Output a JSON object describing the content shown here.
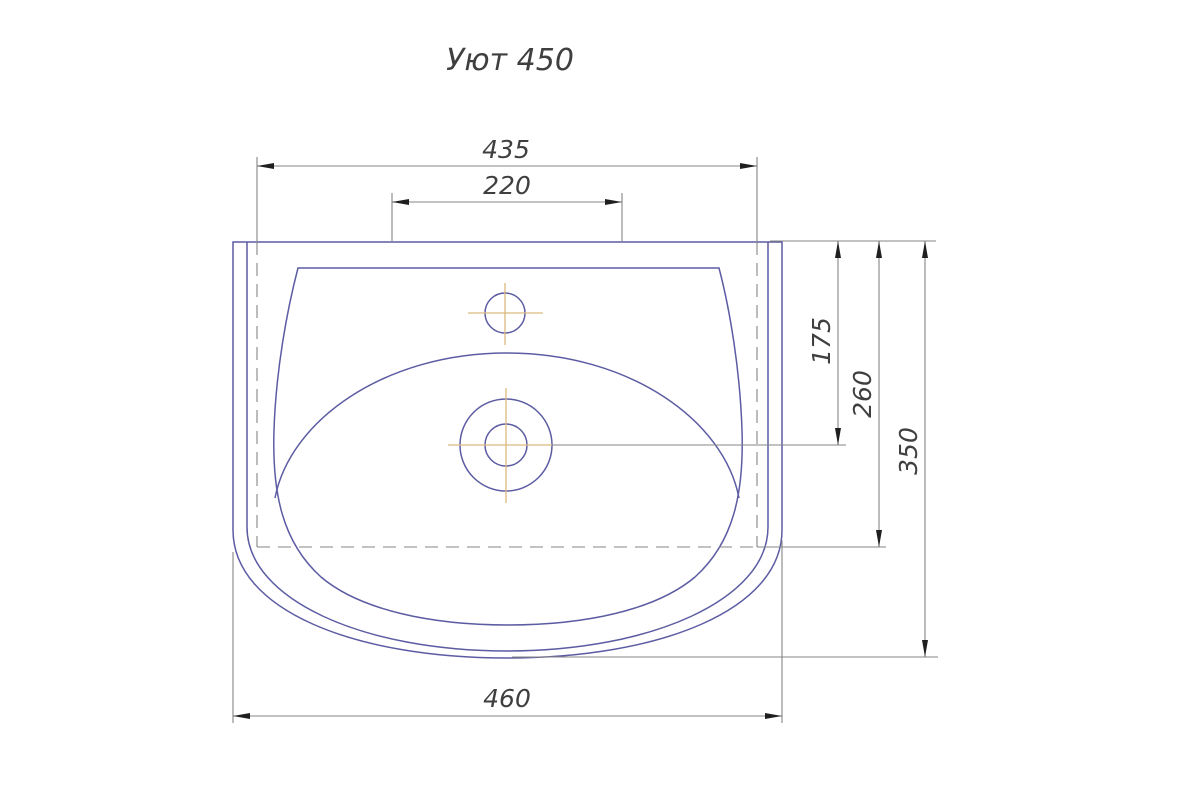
{
  "title": "Уют 450",
  "dimensions": {
    "top_width": "435",
    "faucet_holes_span": "220",
    "faucet_to_drain_depth": "175",
    "front_edge_depth": "260",
    "overall_depth": "350",
    "bottom_width": "460"
  },
  "colors": {
    "outline_blue": "#5c5ca3",
    "dimension_gray": "#858585",
    "centerline_tan": "#dcba80",
    "text_dark": "#3f3f3f",
    "arrow_dark": "#1f1f1f"
  }
}
